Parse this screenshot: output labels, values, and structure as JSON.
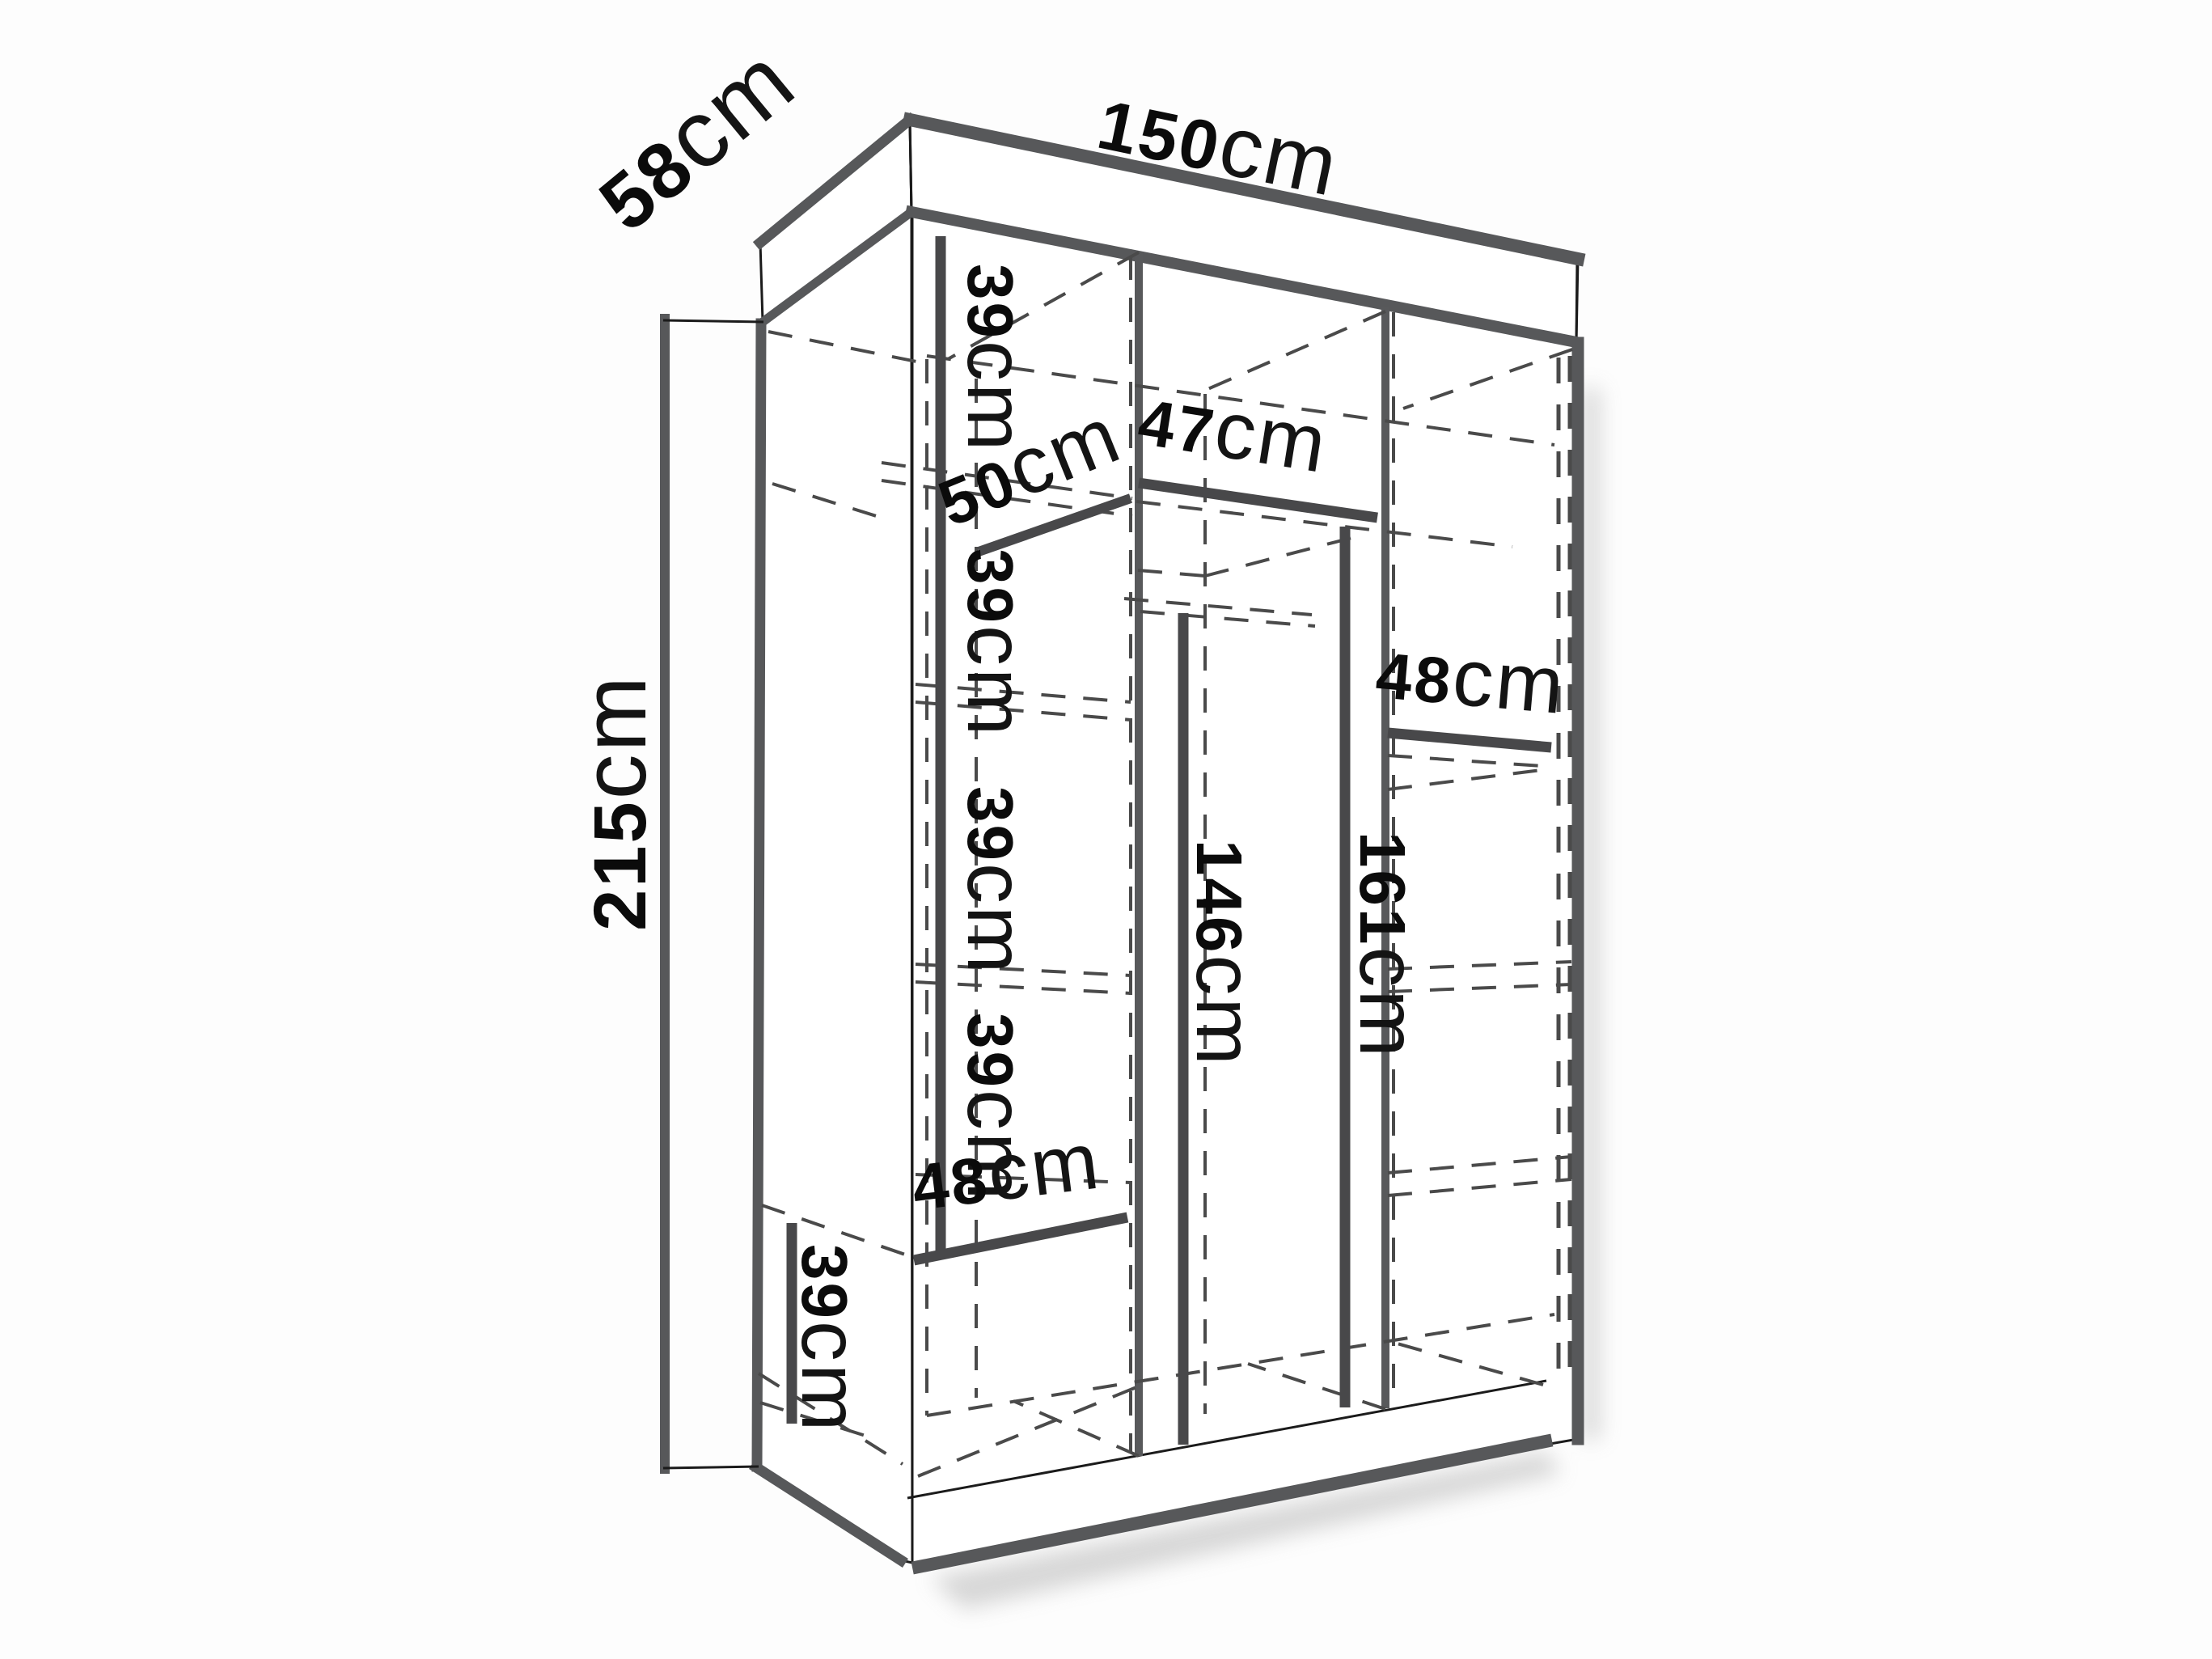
{
  "page": {
    "background": "#fdfdfd",
    "description": "Perspective line drawing of a three-section wardrobe interior with dimension callouts"
  },
  "diagram": {
    "type": "furniture-dimension-diagram",
    "unit": "cm",
    "colors": {
      "outline": "#1b1b1b",
      "panel_edge_gray": "#57585a",
      "dimension_line": "#48484a",
      "hidden_line": "#4a4a4a",
      "label_text": "#0b0b0b"
    },
    "overall": {
      "width_cm": 150,
      "depth_cm": 58,
      "height_cm": 215
    },
    "interior_sections": {
      "left_column_shelf_spacings_cm": [
        39,
        39,
        39,
        39,
        39
      ],
      "left_column_shelf_depth_cm": 50,
      "left_column_bottom_width_cm": 48,
      "middle_column_top_width_cm": 47,
      "middle_column_hanging_height_cm": 146,
      "middle_column_clear_height_cm": 161,
      "right_column_shelf_width_cm": 48
    }
  },
  "dims": {
    "width_150": {
      "value": "150",
      "unit": "cm"
    },
    "depth_58": {
      "value": "58",
      "unit": "cm"
    },
    "height_215": {
      "value": "215",
      "unit": "cm"
    },
    "left_sec1_39": {
      "value": "39",
      "unit": "cm"
    },
    "left_shelf_50": {
      "value": "50",
      "unit": "cm"
    },
    "left_sec2_39": {
      "value": "39",
      "unit": "cm"
    },
    "mid_top_47": {
      "value": "47",
      "unit": "cm"
    },
    "right_shelf_48": {
      "value": "48",
      "unit": "cm"
    },
    "left_sec3_39": {
      "value": "39",
      "unit": "cm"
    },
    "mid_hang_146": {
      "value": "146",
      "unit": "cm"
    },
    "mid_clear_161": {
      "value": "161",
      "unit": "cm"
    },
    "left_sec4_39": {
      "value": "39",
      "unit": "cm"
    },
    "left_bottom_48": {
      "value": "48",
      "unit": "cm"
    },
    "left_sec5_39": {
      "value": "39",
      "unit": "cm"
    }
  }
}
